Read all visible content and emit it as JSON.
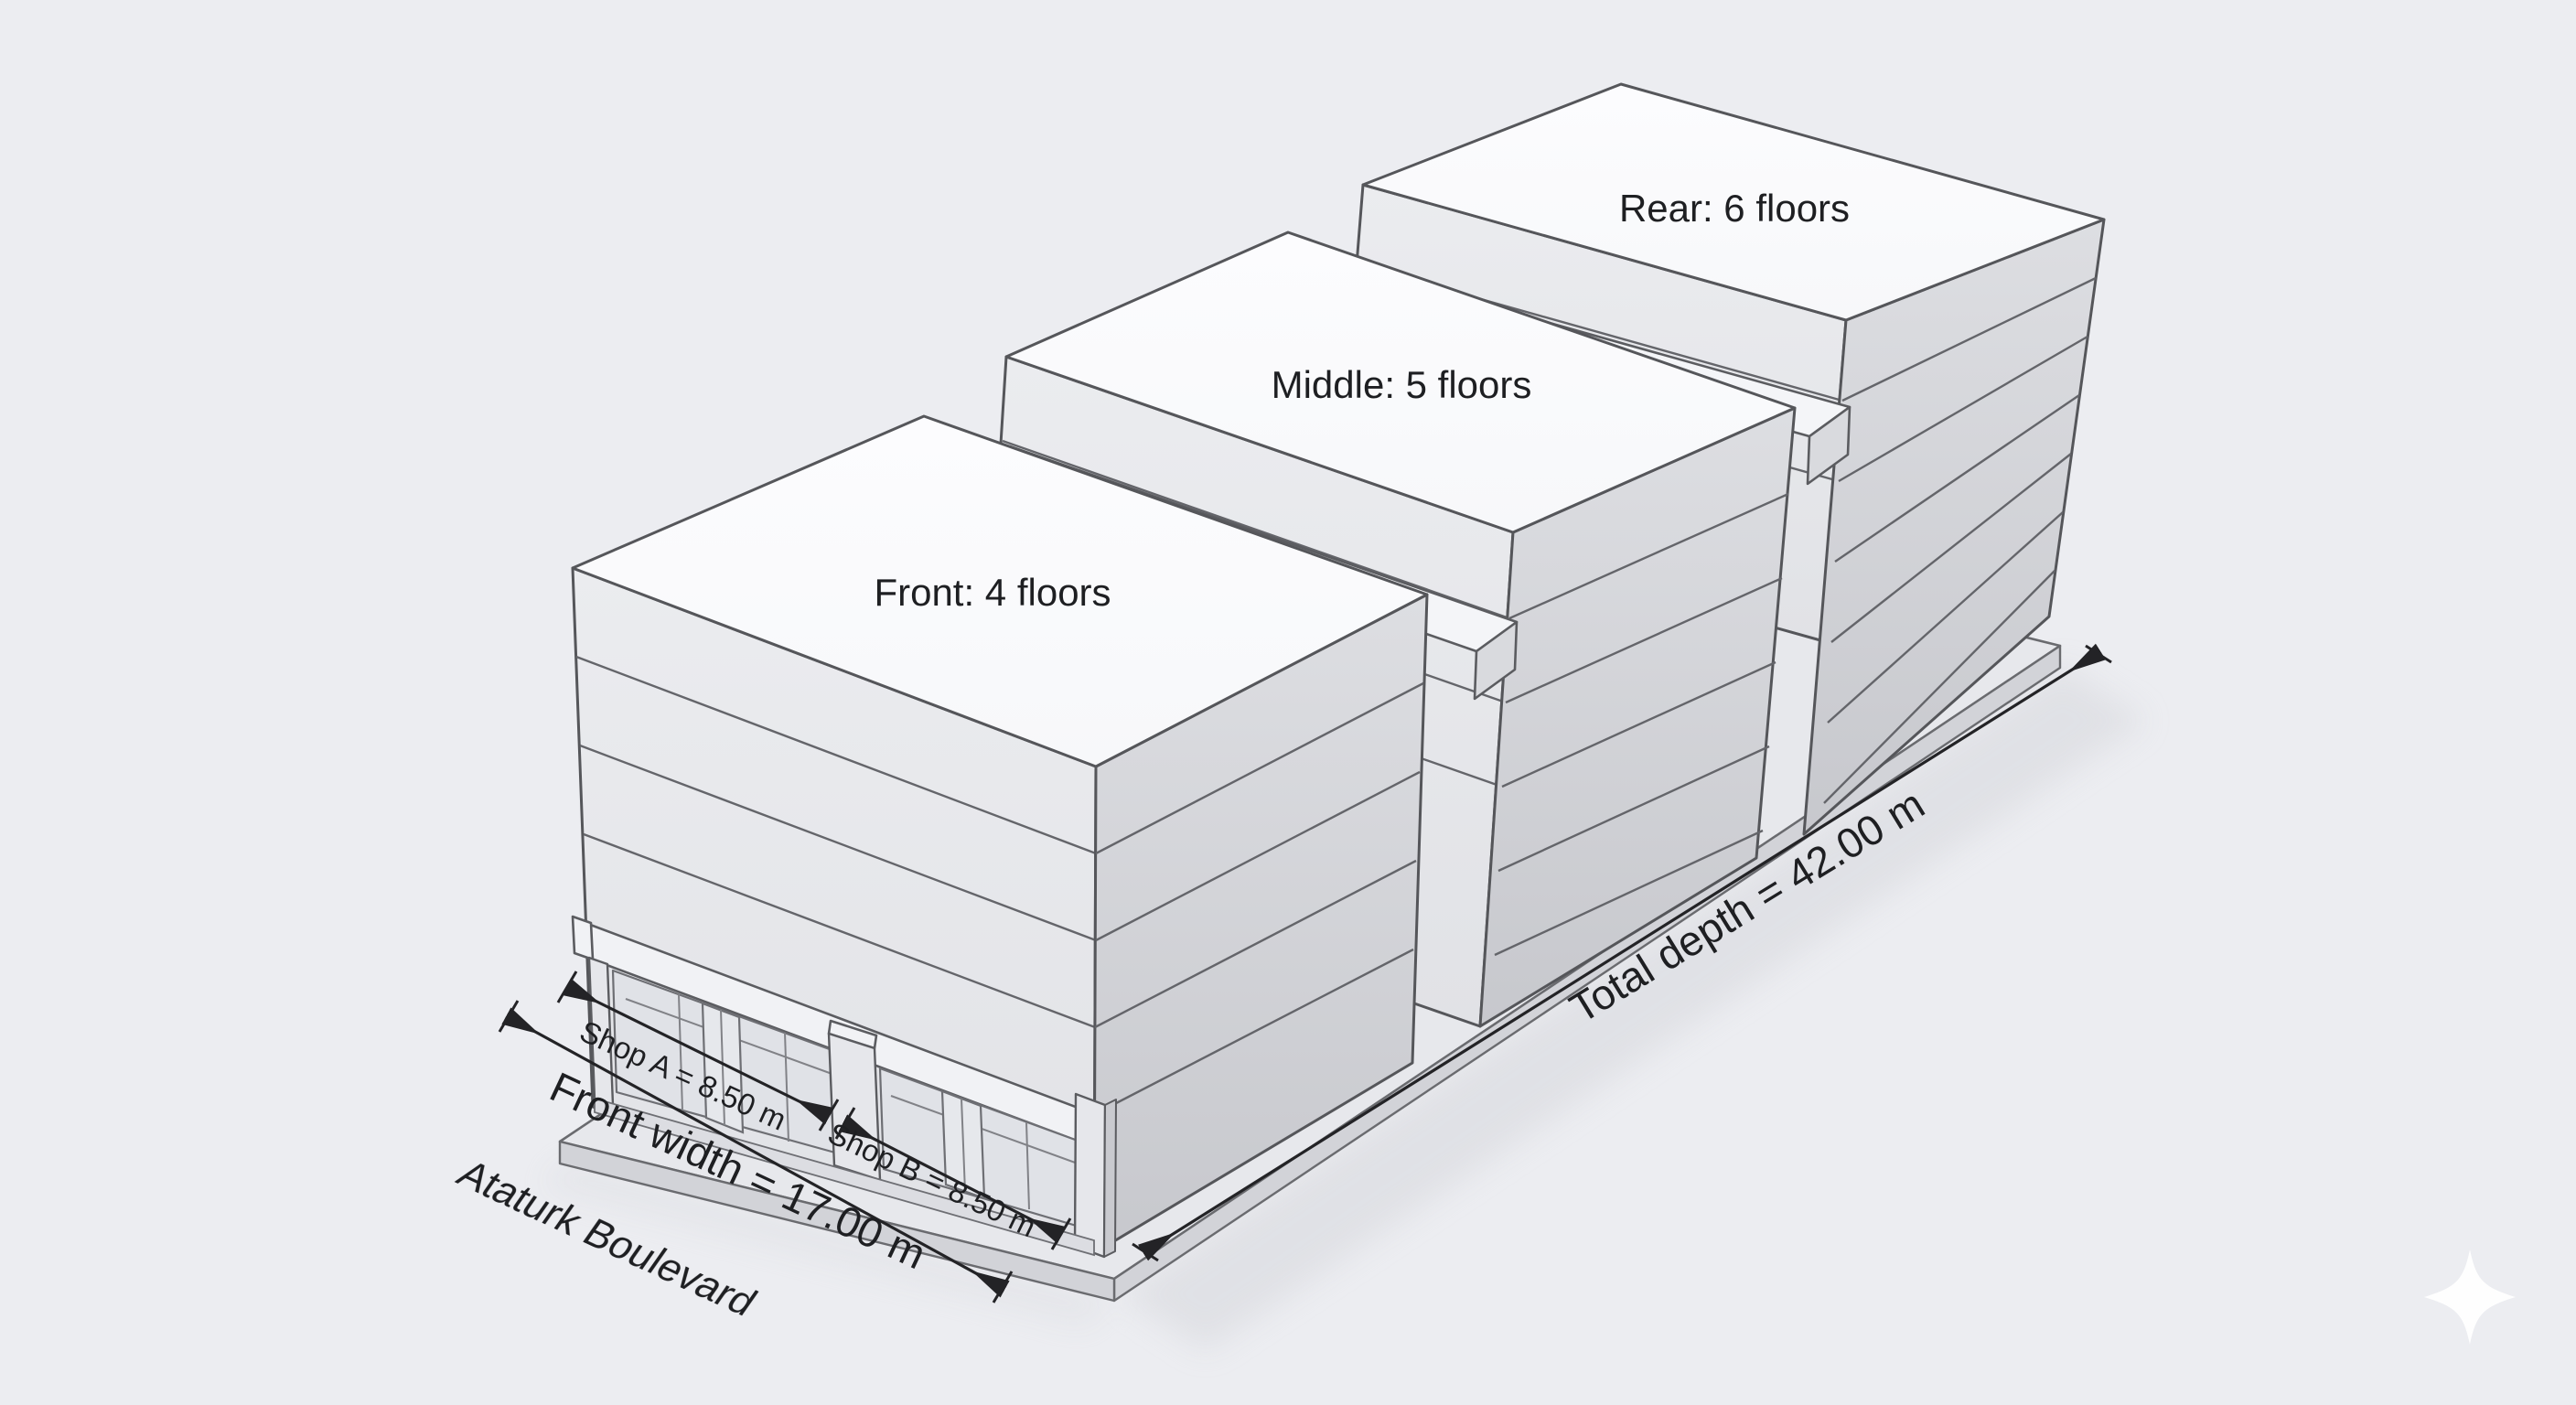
{
  "buildings": {
    "front": {
      "label": "Front: 4 floors",
      "floors": 4
    },
    "middle": {
      "label": "Middle: 5 floors",
      "floors": 5
    },
    "rear": {
      "label": "Rear: 6 floors",
      "floors": 6
    }
  },
  "dimensions": {
    "shop_a": {
      "label": "Shop A = 8.50 m",
      "meters": 8.5
    },
    "shop_b": {
      "label": "Shop B = 8.50 m",
      "meters": 8.5
    },
    "front_width": {
      "label": "Front width = 17.00 m",
      "meters": 17.0
    },
    "total_depth": {
      "label": "Total depth = 42.00 m",
      "meters": 42.0
    }
  },
  "street": {
    "name": "Ataturk Boulevard"
  },
  "icons": {
    "sparkle": "four-pointed-star-watermark"
  },
  "colors": {
    "background": "#ecedf1",
    "outline": "#55565a",
    "dimension": "#232326",
    "top_face": "#fbfbfd",
    "street_face": "#e9eaee",
    "side_face": "#d5d6da"
  }
}
